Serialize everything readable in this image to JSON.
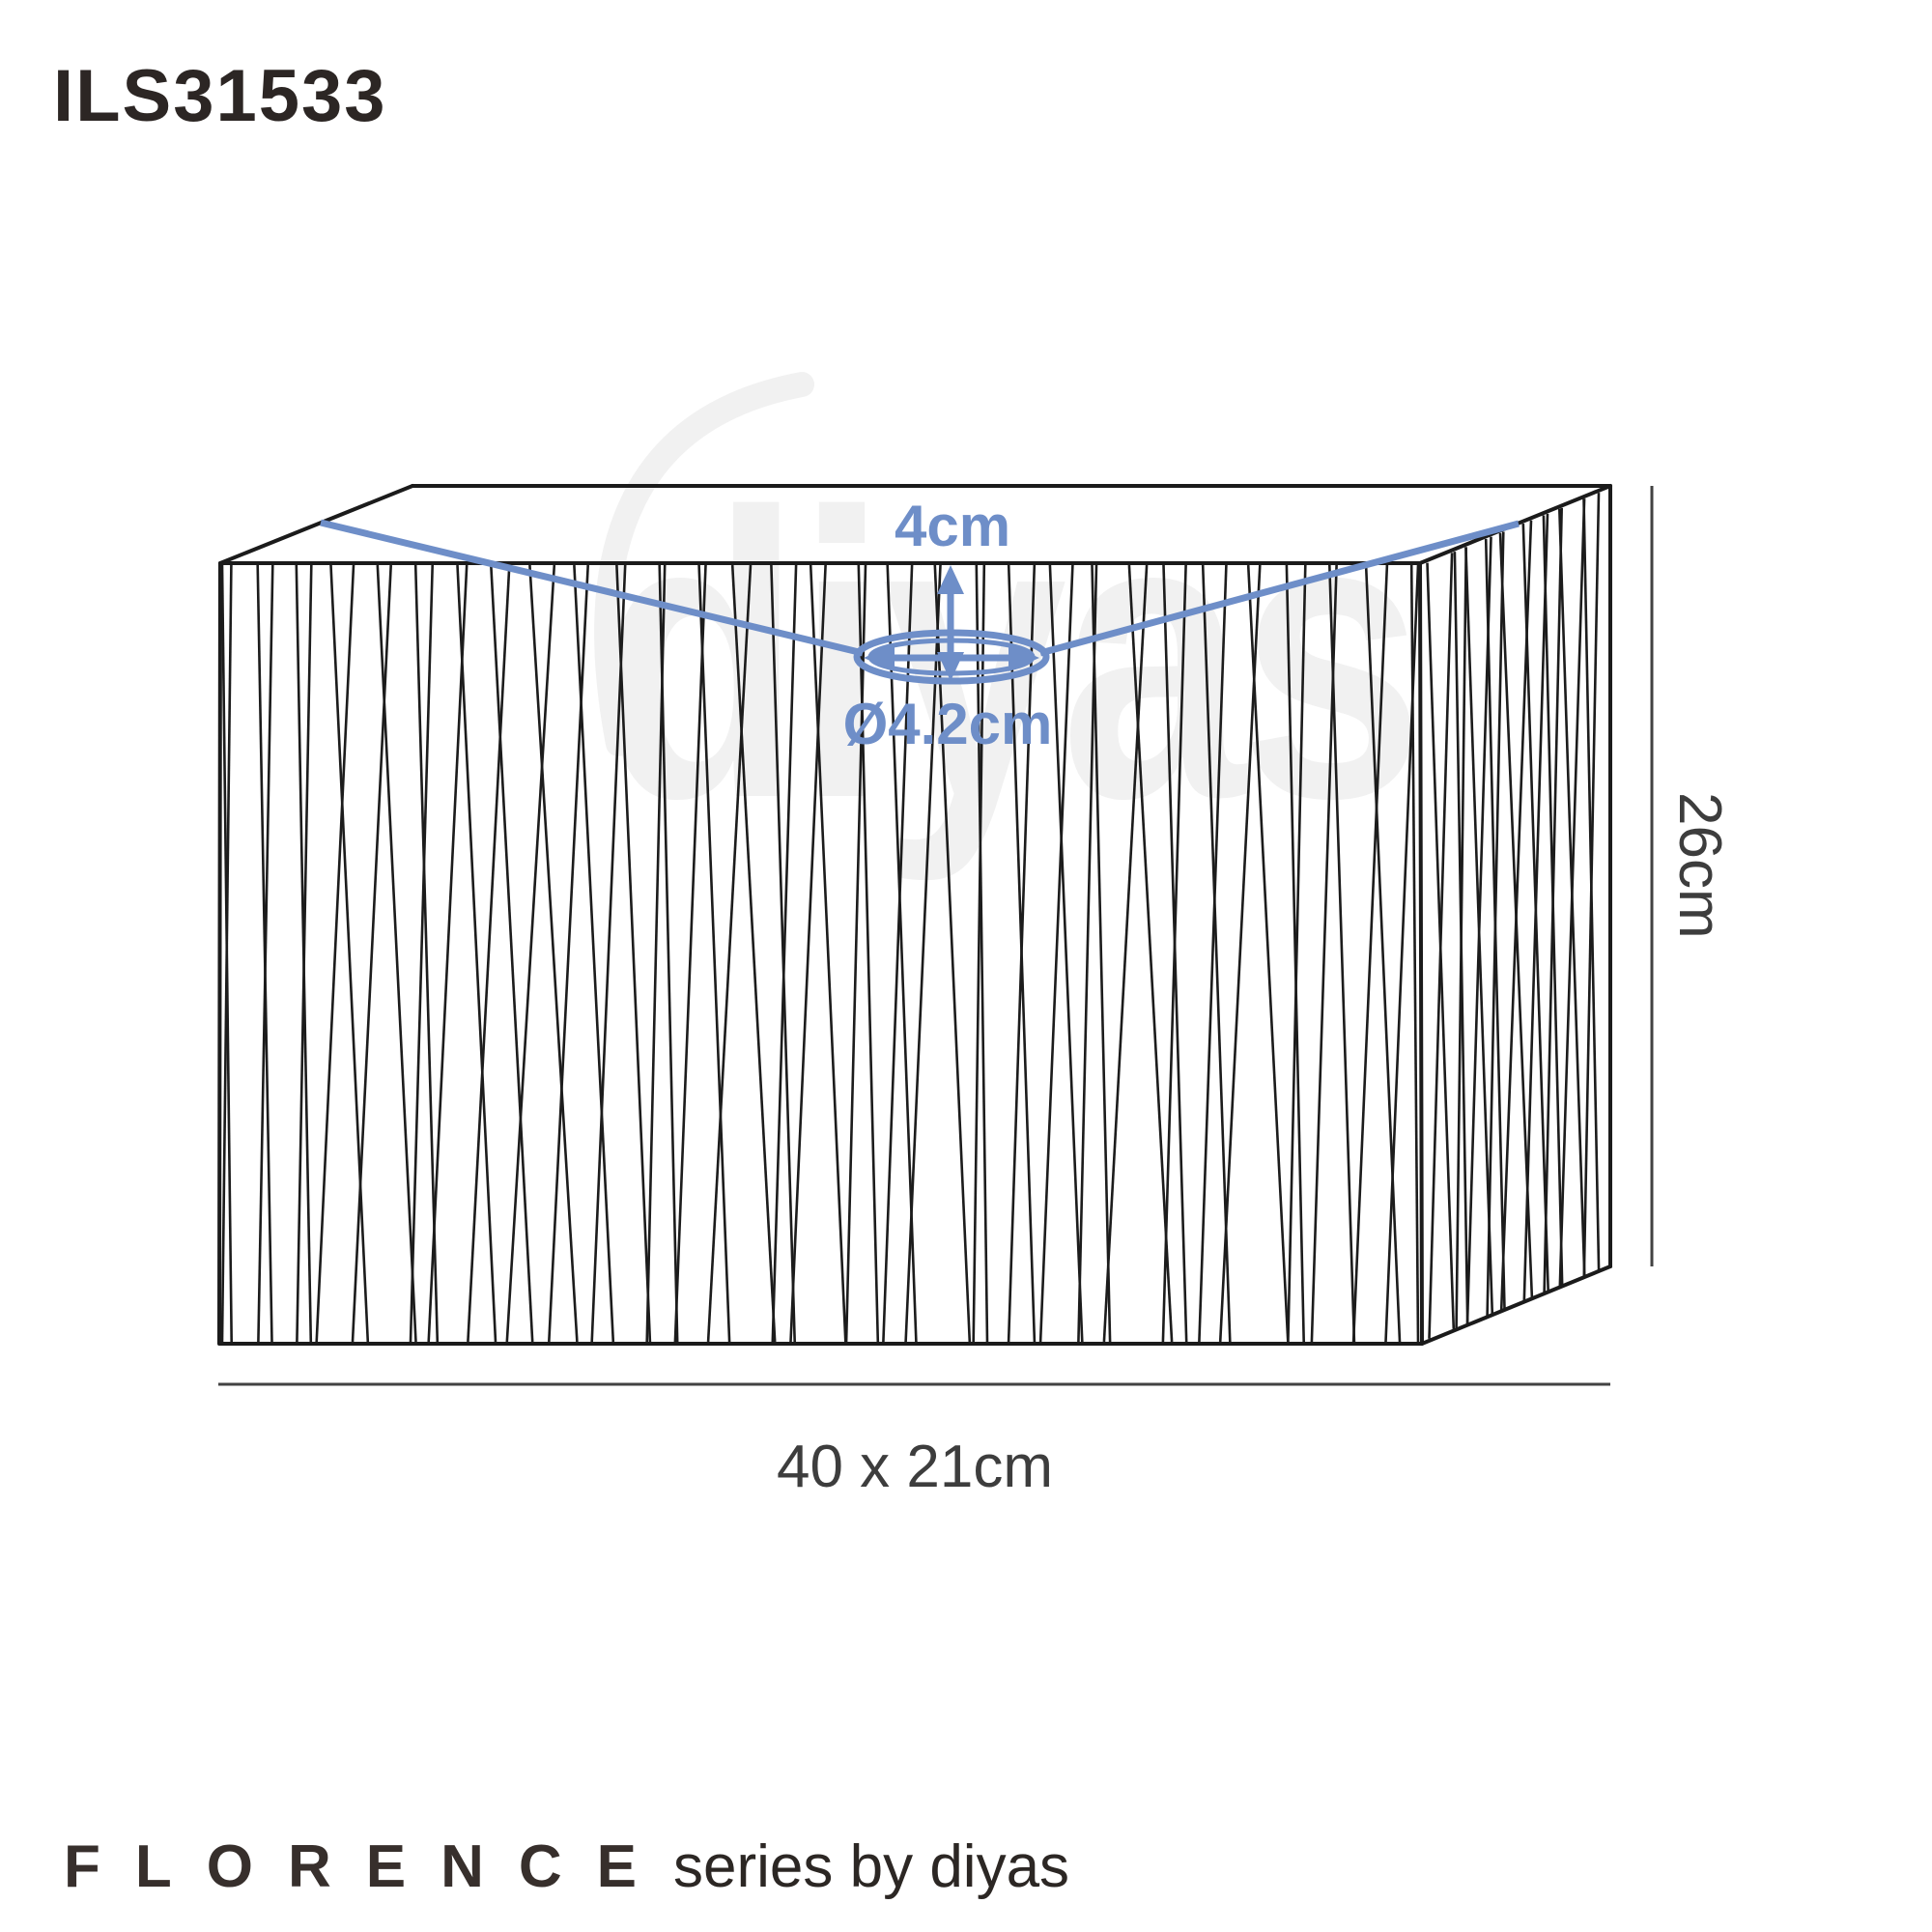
{
  "header": {
    "product_code": "ILS31533"
  },
  "diagram": {
    "dimensions": {
      "drop_label": "4cm",
      "ring_label": "Ø4.2cm",
      "height_label": "26cm",
      "base_label": "40 x 21cm"
    },
    "watermark_text": "diyas",
    "colors": {
      "annotation_blue": "#6e8ec8",
      "line_black": "#1b1b1b",
      "dimension_gray": "#424242",
      "code_dark": "#2c2624",
      "brand_dark": "#372f2c",
      "watermark_gray": "#f1f1f1"
    }
  },
  "footer": {
    "series_name": "FLORENCE",
    "series_byline": "series by diyas"
  }
}
